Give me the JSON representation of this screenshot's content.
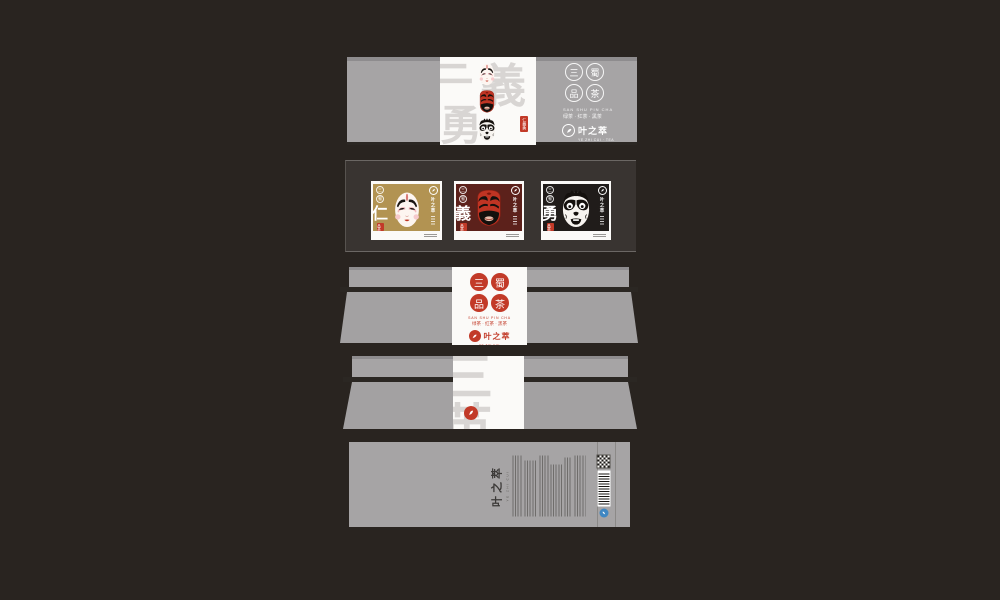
{
  "canvas": {
    "width": 1000,
    "height": 600,
    "background": "#292420"
  },
  "colors": {
    "panel_gray": "#a6a4a5",
    "panel_edge_dark": "#8e8c8e",
    "fold_dark": "#2b2723",
    "shelf_frame_dark": "#393431",
    "paper_white": "#fbfaf8",
    "seal_red": "#c23a28",
    "box_gold": "#b29352",
    "box_maroon": "#5c211b",
    "box_black": "#201c1a",
    "watermark_gray": "#d8d5d3",
    "eco_blue": "#3f87c2"
  },
  "brand": {
    "name": "叶之萃",
    "name_latin": "YE ZHI CUI · TEA",
    "series_seal_chars": [
      "三",
      "蜀",
      "品",
      "茶"
    ],
    "series_pinyin": "SAN SHU PIN CHA",
    "series_variants": "绿茶 · 红茶 · 黑茶",
    "virtues_watermark": "仁義勇",
    "heroes_watermark": "三英",
    "small_seal_text": "品茶"
  },
  "tea_boxes": [
    {
      "virtue": "仁",
      "hero_mask": "liu-bei-white-face"
    },
    {
      "virtue": "義",
      "hero_mask": "guan-yu-red-face"
    },
    {
      "virtue": "勇",
      "hero_mask": "zhang-fei-black-face"
    }
  ],
  "bottom_panel": {
    "brand": "叶之萃",
    "brand_latin": "YE ZHI CUI"
  }
}
